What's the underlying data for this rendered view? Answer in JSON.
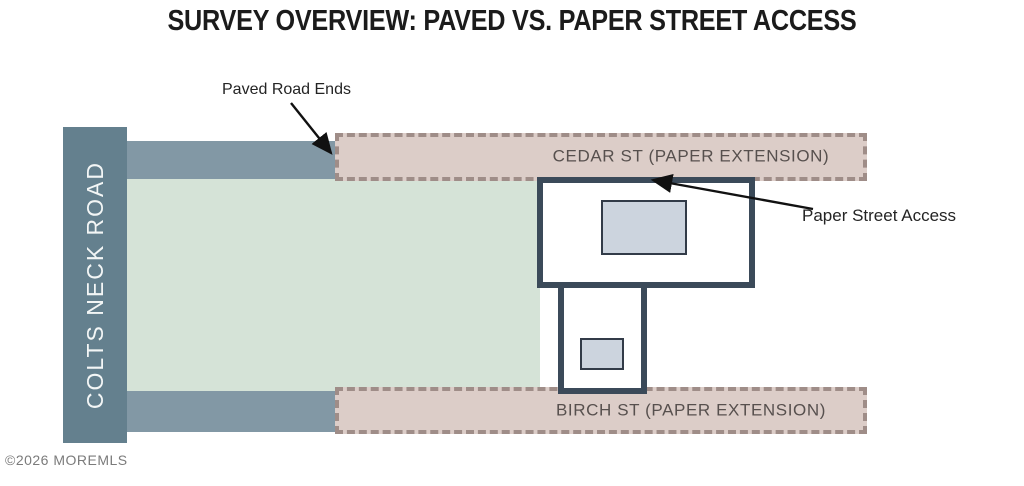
{
  "title": "SURVEY OVERVIEW: PAVED VS. PAPER STREET ACCESS",
  "roads": {
    "colts_neck": {
      "label": "COLTS NECK ROAD",
      "type": "paved main road"
    },
    "cedar": {
      "label": "CEDAR ST (PAPER EXTENSION)",
      "type": "paper street"
    },
    "birch": {
      "label": "BIRCH ST (PAPER EXTENSION)",
      "type": "paper street"
    }
  },
  "annotations": {
    "paved_road_ends": "Paved Road Ends",
    "paper_street_access": "Paper Street Access"
  },
  "watermark": "©2026 MOREMLS",
  "colors": {
    "paved_road": "#8298a5",
    "main_road": "#64808e",
    "parcel_green": "#d5e3d7",
    "paper_street_fill": "#dccdc8",
    "paper_street_dash": "#9f8d88",
    "lot_border": "#3b4a59",
    "building_fill": "#ccd4de",
    "arrow": "#111111"
  }
}
